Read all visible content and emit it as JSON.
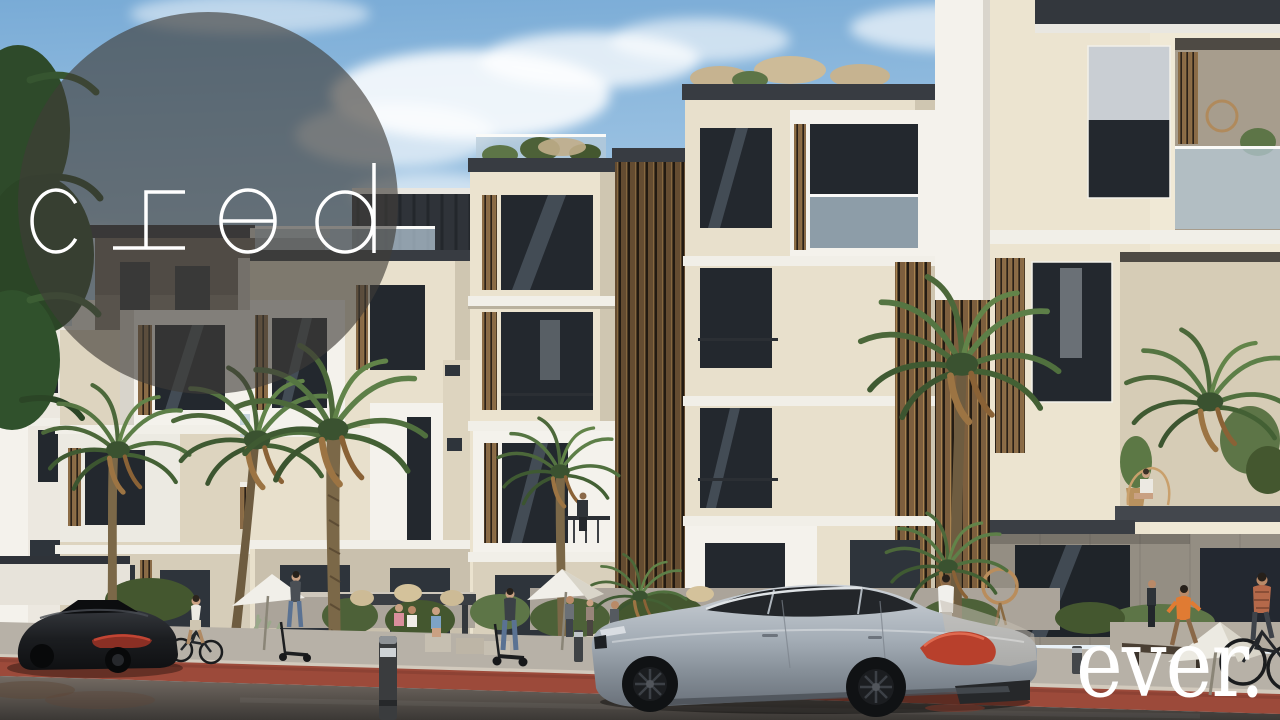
{
  "branding": {
    "logo_text": "cred",
    "watermark_text": "ever."
  },
  "colors": {
    "sky_top": "#79abd6",
    "sky_horizon": "#ecf3f7",
    "logo_circle_overlay": "rgba(64,60,56,0.63)",
    "logo_text_color": "#ffffff",
    "watermark_color": "#ffffff",
    "facade_cream": "#e8e0cc",
    "facade_white": "#f4f2ec",
    "wood_louver": "#8a6b47",
    "window_glass": "#23282e",
    "glass_balustrade": "#b7cbd8",
    "palm_green": "#5d7a46",
    "bike_lane_red": "#9c4a3a",
    "asphalt_gray": "#46423e",
    "sidewalk_gray": "#b7b1a7",
    "silver_car_body": "#9aa3ac",
    "dark_car_body": "#17181b",
    "taillight_red": "#c2392a"
  }
}
